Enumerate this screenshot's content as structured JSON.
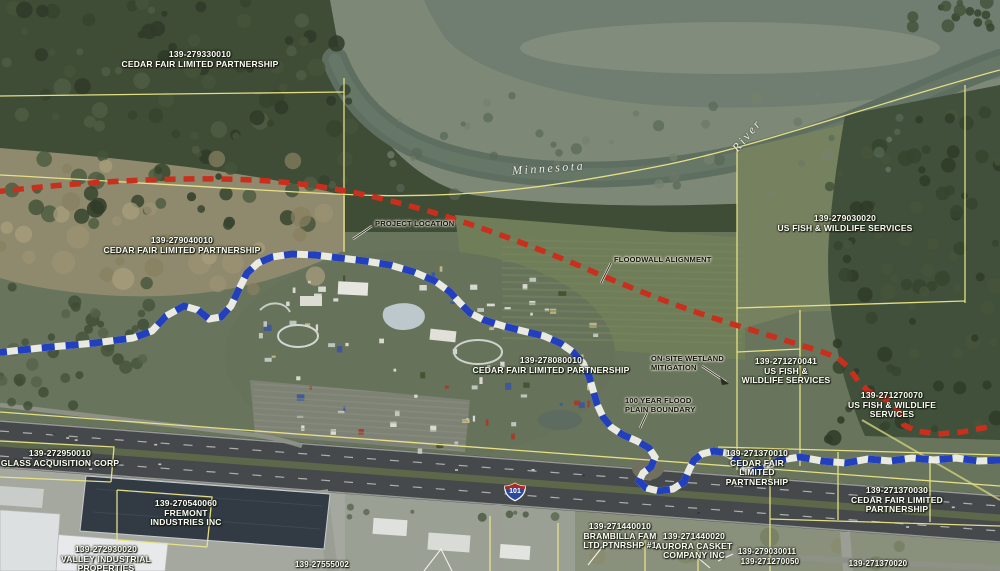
{
  "river": {
    "name_part1": "Minnesota",
    "name_part2": "River"
  },
  "highway": {
    "shield": "101"
  },
  "colors": {
    "alignment_red": "#c92f1c",
    "boundary_blue": "#2240bd",
    "parcel_line_yellow": "#ece588",
    "label_text": "#fdfdf5"
  },
  "parcels": [
    {
      "id": "139-279330010",
      "owner": [
        "CEDAR FAIR LIMITED PARTNERSHIP"
      ],
      "x": 200,
      "y": 50,
      "small": false
    },
    {
      "id": "139-279040010",
      "owner": [
        "CEDAR FAIR LIMITED PARTNERSHIP"
      ],
      "x": 182,
      "y": 236,
      "small": false
    },
    {
      "id": "139-279030020",
      "owner": [
        "US FISH & WILDLIFE SERVICES"
      ],
      "x": 845,
      "y": 214,
      "small": false
    },
    {
      "id": "139-278080010",
      "owner": [
        "CEDAR FAIR LIMITED PARTNERSHIP"
      ],
      "x": 551,
      "y": 356,
      "small": false
    },
    {
      "id": "139-271270041",
      "owner": [
        "US FISH &",
        "WILDLIFE SERVICES"
      ],
      "x": 786,
      "y": 357,
      "small": false
    },
    {
      "id": "139-271270070",
      "owner": [
        "US FISH & WILDLIFE",
        "SERVICES"
      ],
      "x": 892,
      "y": 391,
      "small": false
    },
    {
      "id": "139-272950010",
      "owner": [
        "GLASS ACQUISITION CORP"
      ],
      "x": 60,
      "y": 449,
      "small": false
    },
    {
      "id": "139-270540060",
      "owner": [
        "FREMONT",
        "INDUSTRIES INC"
      ],
      "x": 186,
      "y": 499,
      "small": false
    },
    {
      "id": "139-272930020",
      "owner": [
        "VALLEY INDUSTRIAL",
        "PROPERTIES"
      ],
      "x": 106,
      "y": 545,
      "small": false
    },
    {
      "id": "139-271370010",
      "owner": [
        "CEDAR FAIR",
        "LIMITED",
        "PARTNERSHIP"
      ],
      "x": 757,
      "y": 449,
      "small": false
    },
    {
      "id": "139-271370030",
      "owner": [
        "CEDAR FAIR LIMITED",
        "PARTNERSHIP"
      ],
      "x": 897,
      "y": 486,
      "small": false
    },
    {
      "id": "139-271440010",
      "owner": [
        "BRAMBILLA FAM",
        "LTD.PTNRSHP #1"
      ],
      "x": 620,
      "y": 522,
      "small": false
    },
    {
      "id": "139-271440020",
      "owner": [
        "AURORA CASKET",
        "COMPANY INC"
      ],
      "x": 694,
      "y": 532,
      "small": false
    },
    {
      "id": "139-279030011",
      "owner": [],
      "x": 767,
      "y": 548,
      "small": true
    },
    {
      "id": "139-271270050",
      "owner": [],
      "x": 770,
      "y": 558,
      "small": true
    },
    {
      "id": "139-271370020",
      "owner": [],
      "x": 878,
      "y": 560,
      "small": true
    },
    {
      "id": "139-27555002",
      "owner": [],
      "x": 322,
      "y": 561,
      "small": true
    }
  ],
  "callouts": [
    {
      "lines": [
        "PROJECT LOCATION"
      ],
      "x": 375,
      "y": 219
    },
    {
      "lines": [
        "FLOODWALL ALIGNMENT"
      ],
      "x": 614,
      "y": 255
    },
    {
      "lines": [
        "ON-SITE WETLAND",
        "MITIGATION"
      ],
      "x": 651,
      "y": 354
    },
    {
      "lines": [
        "100 YEAR FLOOD",
        "PLAIN BOUNDARY"
      ],
      "x": 625,
      "y": 396
    }
  ]
}
